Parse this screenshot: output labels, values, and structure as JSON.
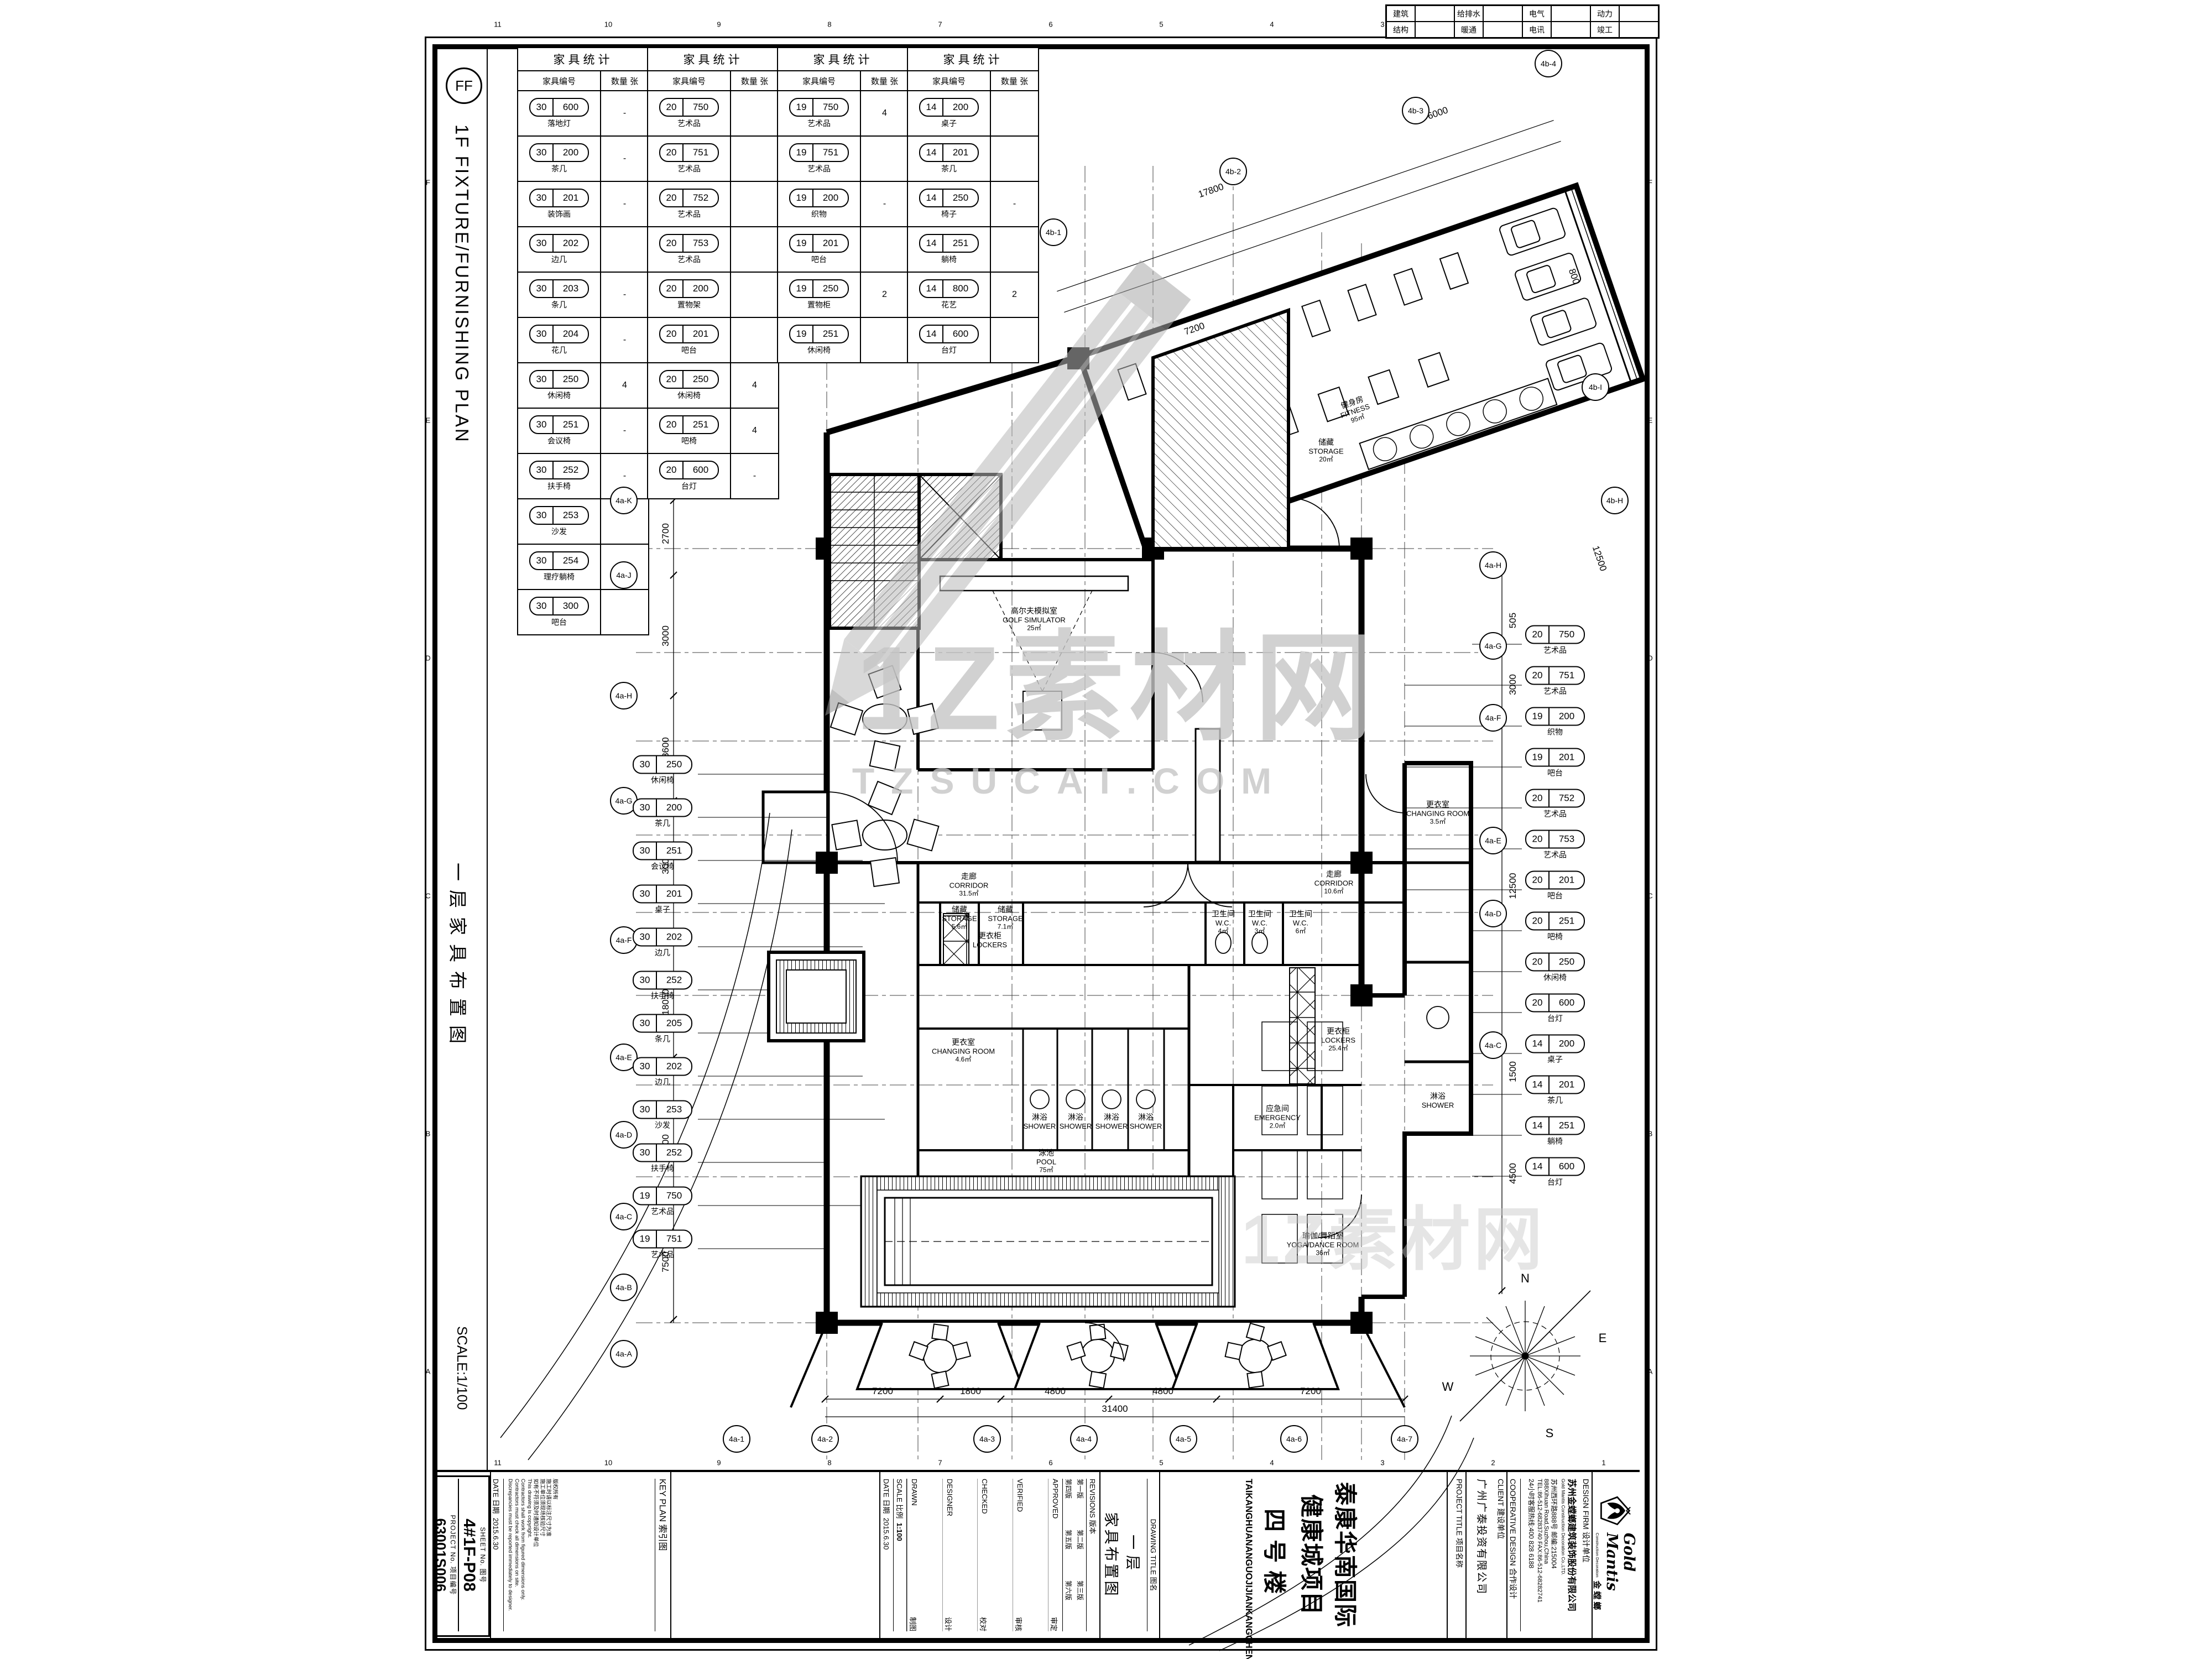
{
  "sheet": {
    "discipline_code": "FF",
    "strip_title_en": "1F FIXTURE/FURNISHING PLAN",
    "strip_title_cn": "一层家具布置图",
    "strip_scale": "SCALE:1/100",
    "margin_numbers": [
      "11",
      "10",
      "9",
      "8",
      "7",
      "6",
      "5",
      "4",
      "3",
      "2",
      "1"
    ],
    "margin_letters": [
      "F",
      "E",
      "D",
      "C",
      "B",
      "A"
    ]
  },
  "coord_table": {
    "rows": [
      [
        "建筑",
        "给排水",
        "电气",
        "动力"
      ],
      [
        "结构",
        "暖通",
        "电讯",
        "竣工"
      ]
    ]
  },
  "furniture_tables": [
    {
      "title": "家具统计",
      "col1": "家具编号",
      "col2": "数量 张",
      "rows": [
        {
          "a": "30",
          "b": "600",
          "label": "落地灯",
          "qty": "-"
        },
        {
          "a": "30",
          "b": "200",
          "label": "茶几",
          "qty": "-"
        },
        {
          "a": "30",
          "b": "201",
          "label": "装饰画",
          "qty": "-"
        },
        {
          "a": "30",
          "b": "202",
          "label": "边几",
          "qty": ""
        },
        {
          "a": "30",
          "b": "203",
          "label": "条几",
          "qty": "-"
        },
        {
          "a": "30",
          "b": "204",
          "label": "花几",
          "qty": "-"
        },
        {
          "a": "30",
          "b": "250",
          "label": "休闲椅",
          "qty": "4"
        },
        {
          "a": "30",
          "b": "251",
          "label": "会议椅",
          "qty": "-"
        },
        {
          "a": "30",
          "b": "252",
          "label": "扶手椅",
          "qty": "-"
        },
        {
          "a": "30",
          "b": "253",
          "label": "沙发",
          "qty": ""
        },
        {
          "a": "30",
          "b": "254",
          "label": "理疗躺椅",
          "qty": "4"
        },
        {
          "a": "30",
          "b": "300",
          "label": "吧台",
          "qty": ""
        }
      ]
    },
    {
      "title": "家具统计",
      "col1": "家具编号",
      "col2": "数量 张",
      "rows": [
        {
          "a": "20",
          "b": "750",
          "label": "艺术品",
          "qty": ""
        },
        {
          "a": "20",
          "b": "751",
          "label": "艺术品",
          "qty": ""
        },
        {
          "a": "20",
          "b": "752",
          "label": "艺术品",
          "qty": ""
        },
        {
          "a": "20",
          "b": "753",
          "label": "艺术品",
          "qty": ""
        },
        {
          "a": "20",
          "b": "200",
          "label": "置物架",
          "qty": ""
        },
        {
          "a": "20",
          "b": "201",
          "label": "吧台",
          "qty": ""
        },
        {
          "a": "20",
          "b": "250",
          "label": "休闲椅",
          "qty": "4"
        },
        {
          "a": "20",
          "b": "251",
          "label": "吧椅",
          "qty": "4"
        },
        {
          "a": "20",
          "b": "600",
          "label": "台灯",
          "qty": "-"
        }
      ]
    },
    {
      "title": "家具统计",
      "col1": "家具编号",
      "col2": "数量 张",
      "rows": [
        {
          "a": "19",
          "b": "750",
          "label": "艺术品",
          "qty": "4"
        },
        {
          "a": "19",
          "b": "751",
          "label": "艺术品",
          "qty": ""
        },
        {
          "a": "19",
          "b": "200",
          "label": "织物",
          "qty": "-"
        },
        {
          "a": "19",
          "b": "201",
          "label": "吧台",
          "qty": ""
        },
        {
          "a": "19",
          "b": "250",
          "label": "置物柜",
          "qty": "2"
        },
        {
          "a": "19",
          "b": "251",
          "label": "休闲椅",
          "qty": ""
        }
      ]
    },
    {
      "title": "家具统计",
      "col1": "家具编号",
      "col2": "数量 张",
      "rows": [
        {
          "a": "14",
          "b": "200",
          "label": "桌子",
          "qty": ""
        },
        {
          "a": "14",
          "b": "201",
          "label": "茶几",
          "qty": ""
        },
        {
          "a": "14",
          "b": "250",
          "label": "椅子",
          "qty": "-"
        },
        {
          "a": "14",
          "b": "251",
          "label": "躺椅",
          "qty": ""
        },
        {
          "a": "14",
          "b": "800",
          "label": "花艺",
          "qty": "2"
        },
        {
          "a": "14",
          "b": "600",
          "label": "台灯",
          "qty": ""
        }
      ]
    }
  ],
  "plan": {
    "rooms": [
      {
        "cn": "走廊",
        "en": "CORRIDOR",
        "area": "31.5㎡"
      },
      {
        "cn": "走廊",
        "en": "CORRIDOR",
        "area": "10.6㎡"
      },
      {
        "cn": "储藏",
        "en": "STORAGE",
        "area": "5.6㎡"
      },
      {
        "cn": "储藏",
        "en": "STORAGE",
        "area": "7.1㎡"
      },
      {
        "cn": "储藏",
        "en": "STORAGE",
        "area": "20㎡"
      },
      {
        "cn": "高尔夫模拟室",
        "en": "GOLF SIMULATOR",
        "area": "25㎡"
      },
      {
        "cn": "健身房",
        "en": "FITNESS",
        "area": "95㎡"
      },
      {
        "cn": "泳池",
        "en": "POOL",
        "area": "75㎡"
      },
      {
        "cn": "瑜伽/舞蹈室",
        "en": "YOGA/DANCE ROOM",
        "area": "36㎡"
      },
      {
        "cn": "更衣室",
        "en": "CHANGING ROOM",
        "area": "4.6㎡"
      },
      {
        "cn": "更衣室",
        "en": "CHANGING ROOM",
        "area": "3.5㎡"
      },
      {
        "cn": "淋浴",
        "en": "SHOWER",
        "area": ""
      },
      {
        "cn": "淋浴",
        "en": "SHOWER",
        "area": ""
      },
      {
        "cn": "淋浴",
        "en": "SHOWER",
        "area": ""
      },
      {
        "cn": "淋浴",
        "en": "SHOWER",
        "area": ""
      },
      {
        "cn": "更衣柜",
        "en": "LOCKERS",
        "area": ""
      },
      {
        "cn": "更衣柜",
        "en": "LOCKERS",
        "area": "25.4㎡"
      },
      {
        "cn": "卫生间",
        "en": "W.C.",
        "area": "4㎡"
      },
      {
        "cn": "卫生间",
        "en": "W.C.",
        "area": "3㎡"
      },
      {
        "cn": "卫生间",
        "en": "W.C.",
        "area": "6㎡"
      },
      {
        "cn": "应急间",
        "en": "EMERGENCY",
        "area": "2.0㎡"
      },
      {
        "cn": "淋浴",
        "en": "SHOWER",
        "area": ""
      }
    ],
    "bubbles_left": [
      "4a-K",
      "4a-J",
      "4a-H",
      "4a-G",
      "4a-F",
      "4a-E",
      "4a-D",
      "4a-C",
      "4a-B",
      "4a-A"
    ],
    "bubbles_bottom": [
      "4a-1",
      "4a-2",
      "4a-3",
      "4a-4",
      "4a-5",
      "4a-6",
      "4a-7"
    ],
    "bubbles_right": [
      "4a-H",
      "4a-G",
      "4a-F",
      "4a-E",
      "4a-D",
      "4a-C"
    ],
    "bubbles_wing": [
      "4b-1",
      "4b-2",
      "4b-3",
      "4b-4",
      "4b-I",
      "4b-H"
    ],
    "dims": [
      "7200",
      "1800",
      "4800",
      "4800",
      "7200",
      "31400",
      "2700",
      "3000",
      "3600",
      "3000",
      "18050",
      "3000",
      "7500",
      "505",
      "3000",
      "12500",
      "1500",
      "4500",
      "17800",
      "6000",
      "7200",
      "12500",
      "800"
    ],
    "tags_left": [
      {
        "a": "30",
        "b": "250",
        "label": "休闲椅"
      },
      {
        "a": "30",
        "b": "200",
        "label": "茶几"
      },
      {
        "a": "30",
        "b": "251",
        "label": "会议椅"
      },
      {
        "a": "30",
        "b": "201",
        "label": "桌子"
      },
      {
        "a": "30",
        "b": "202",
        "label": "边几"
      },
      {
        "a": "30",
        "b": "252",
        "label": "扶手椅"
      },
      {
        "a": "30",
        "b": "205",
        "label": "条几"
      },
      {
        "a": "30",
        "b": "202",
        "label": "边几"
      },
      {
        "a": "30",
        "b": "253",
        "label": "沙发"
      },
      {
        "a": "30",
        "b": "252",
        "label": "扶手椅"
      },
      {
        "a": "19",
        "b": "750",
        "label": "艺术品"
      },
      {
        "a": "19",
        "b": "751",
        "label": "艺术品"
      }
    ],
    "tags_right": [
      {
        "a": "20",
        "b": "750",
        "label": "艺术品"
      },
      {
        "a": "20",
        "b": "751",
        "label": "艺术品"
      },
      {
        "a": "19",
        "b": "200",
        "label": "织物"
      },
      {
        "a": "19",
        "b": "201",
        "label": "吧台"
      },
      {
        "a": "20",
        "b": "752",
        "label": "艺术品"
      },
      {
        "a": "20",
        "b": "753",
        "label": "艺术品"
      },
      {
        "a": "20",
        "b": "201",
        "label": "吧台"
      },
      {
        "a": "20",
        "b": "251",
        "label": "吧椅"
      },
      {
        "a": "20",
        "b": "250",
        "label": "休闲椅"
      },
      {
        "a": "20",
        "b": "600",
        "label": "台灯"
      },
      {
        "a": "14",
        "b": "200",
        "label": "桌子"
      },
      {
        "a": "14",
        "b": "201",
        "label": "茶几"
      },
      {
        "a": "14",
        "b": "251",
        "label": "躺椅"
      },
      {
        "a": "14",
        "b": "600",
        "label": "台灯"
      }
    ],
    "compass": {
      "n": "N",
      "e": "E",
      "s": "S",
      "w": "W"
    },
    "watermark": {
      "line1": "1Z素材网",
      "line2": "TZSUCAI.COM"
    }
  },
  "titleblock": {
    "sheet_label": "SHEET No.  图号",
    "sheet_no": "4#1F-P08",
    "project_no_label": "PROJECT No.  项目编号",
    "project_no": "63001S006",
    "key_plan": "KEY PLAN   索引图",
    "date_label": "DATE  日期",
    "date": "2015.6.30",
    "notes": [
      "版权所有",
      "施工时请以标注尺寸为准",
      "施工单位须现场核验尺寸",
      "如有不符须及时通知设计单位",
      "This drawing is copyright.",
      "Contractors shall work from figured dimensions only.",
      "Contractors must check all dimensions on site.",
      "Discrepancies must be reported immediately to designer."
    ],
    "revisions_label": "REVISIONS  版本",
    "revisions": [
      "第一版",
      "第二版",
      "第三版",
      "第四版",
      "第五版",
      "第六版"
    ],
    "approvals": [
      [
        "APPROVED",
        "审定"
      ],
      [
        "VERIFIED",
        "审核"
      ],
      [
        "CHECKED",
        "校对"
      ],
      [
        "DESIGNER",
        "设计"
      ],
      [
        "DRAWN",
        "制图"
      ]
    ],
    "scale_label": "SCALE  比例",
    "scale": "1:100",
    "drawing_title_label": "DRAWING TITLE  图名",
    "drawing_title_cn1": "一层",
    "drawing_title_cn2": "家具布置图",
    "project_title_label": "PROJECT TITLE  项目名称",
    "project_title_cn1": "泰康华南国际健康城项目",
    "project_title_cn2": "四号楼",
    "project_title_py": "TAIKANGHUANANGUOJIJIANKANGCHENGXIANGMU",
    "client_label": "CLIENT  建设单位",
    "client": "广州广泰投资有限公司",
    "coop": "COOPERATIVE DESIGN  合作设计",
    "firm_label": "DESIGN FIRM  设计单位",
    "firm_cn": "苏州金螳螂建筑装饰股份有限公司",
    "firm_en": "Gold Mantis Construction Decoration Co.,LTD.",
    "firm_addr_cn": "苏州西环路888号  邮编:215004",
    "firm_addr_en": "888Xihuan Road,Suzhou,China",
    "firm_tel": "TEL:86-512-68283740  FAX:86-512-68282741",
    "firm_hotline": "24小时客服热线:400 828 6188",
    "logo_brand": "Gold Mantis",
    "logo_brand_cn": "金螳螂",
    "logo_tagline": "Construction Decoration"
  }
}
